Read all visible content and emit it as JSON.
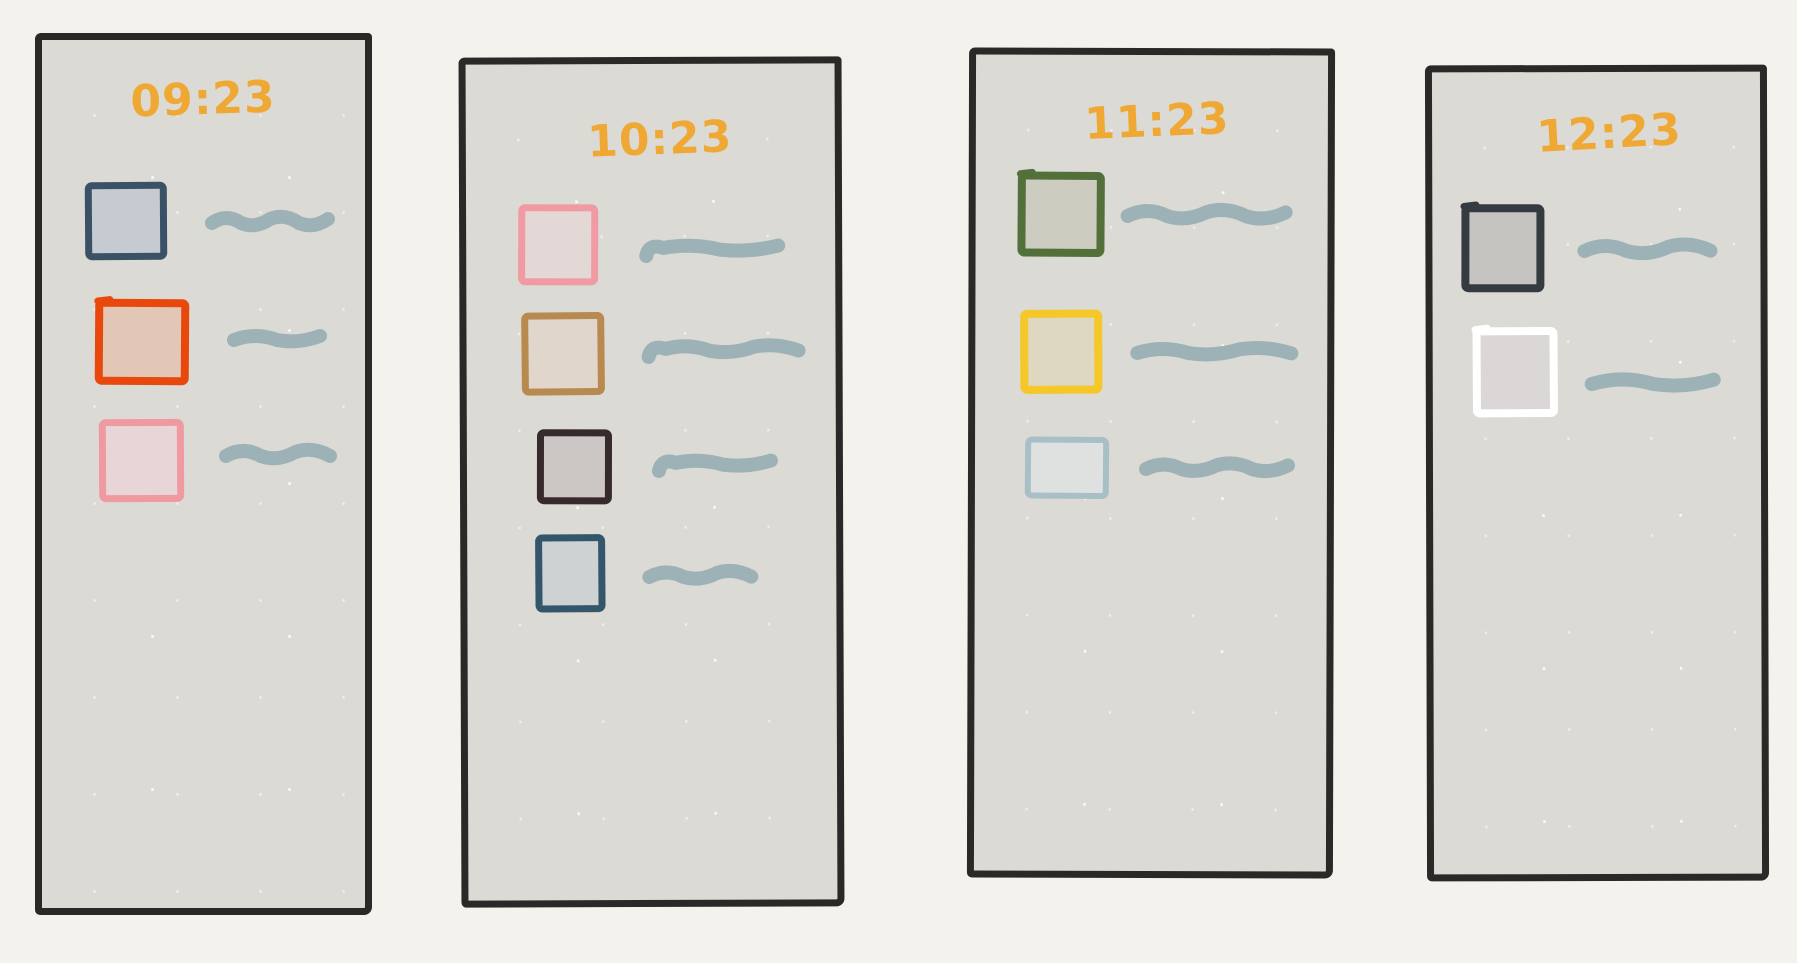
{
  "colors": {
    "background": "#f4f2ed",
    "panel_background": "#dbdad5",
    "panel_border": "#2b2927",
    "time_text": "#f0a834",
    "squiggle_stroke": "#9db2b7"
  },
  "panels": [
    {
      "time": "09:23",
      "frame": {
        "x": 35,
        "y": 33,
        "w": 337,
        "h": 882,
        "rotate": 0
      },
      "time_pos": {
        "x": 76,
        "y": 38,
        "rotate": -2
      },
      "items": [
        {
          "checkbox": {
            "x": 43,
            "y": 142,
            "w": 82,
            "h": 78,
            "border": "#3a5166",
            "fill": "#c6cbd1",
            "bw": 7,
            "overshoot": false,
            "rotate": -0.4,
            "state": "unchecked"
          },
          "squiggle": {
            "x": 163,
            "y": 165,
            "len": 130,
            "bumps": 4,
            "amp": 8,
            "style": "wave"
          }
        },
        {
          "checkbox": {
            "x": 53,
            "y": 259,
            "w": 94,
            "h": 86,
            "border": "#e8480c",
            "fill": "#e2c7b6",
            "bw": 8,
            "overshoot": true,
            "rotate": 0.4,
            "state": "unchecked"
          },
          "squiggle": {
            "x": 185,
            "y": 282,
            "len": 100,
            "bumps": 2,
            "amp": 6,
            "style": "wave"
          }
        },
        {
          "checkbox": {
            "x": 57,
            "y": 379,
            "w": 85,
            "h": 83,
            "border": "#ef9aa0",
            "fill": "#e7d5d8",
            "bw": 7,
            "overshoot": false,
            "rotate": -0.3,
            "state": "unchecked"
          },
          "squiggle": {
            "x": 177,
            "y": 398,
            "len": 118,
            "bumps": 3,
            "amp": 8,
            "style": "wave"
          }
        }
      ]
    },
    {
      "time": "10:23",
      "frame": {
        "x": 460,
        "y": 57,
        "w": 383,
        "h": 850,
        "rotate": -0.2
      },
      "time_pos": {
        "x": 109,
        "y": 54,
        "rotate": -2
      },
      "items": [
        {
          "checkbox": {
            "x": 52,
            "y": 140,
            "w": 80,
            "h": 81,
            "border": "#f09ba4",
            "fill": "#e4d8d6",
            "bw": 7,
            "overshoot": false,
            "rotate": 0.3,
            "state": "unchecked"
          },
          "squiggle": {
            "x": 173,
            "y": 168,
            "len": 146,
            "bumps": 2,
            "amp": 5,
            "style": "hook"
          }
        },
        {
          "checkbox": {
            "x": 55,
            "y": 248,
            "w": 83,
            "h": 83,
            "border": "#b98a50",
            "fill": "#e0d6cc",
            "bw": 7,
            "overshoot": false,
            "rotate": -0.4,
            "state": "unchecked"
          },
          "squiggle": {
            "x": 175,
            "y": 269,
            "len": 164,
            "bumps": 3,
            "amp": 6,
            "style": "hook"
          }
        },
        {
          "checkbox": {
            "x": 70,
            "y": 365,
            "w": 75,
            "h": 75,
            "border": "#372a2c",
            "fill": "#ccc6c4",
            "bw": 7,
            "overshoot": false,
            "rotate": 0.3,
            "state": "unchecked"
          },
          "squiggle": {
            "x": 185,
            "y": 383,
            "len": 126,
            "bumps": 2,
            "amp": 5,
            "style": "hook"
          }
        },
        {
          "checkbox": {
            "x": 68,
            "y": 470,
            "w": 70,
            "h": 78,
            "border": "#33566b",
            "fill": "#ced2d3",
            "bw": 7,
            "overshoot": false,
            "rotate": -0.2,
            "state": "unchecked"
          },
          "squiggle": {
            "x": 175,
            "y": 495,
            "len": 116,
            "bumps": 3,
            "amp": 7,
            "style": "wave"
          }
        }
      ]
    },
    {
      "time": "11:23",
      "frame": {
        "x": 968,
        "y": 48,
        "w": 366,
        "h": 830,
        "rotate": 0.15
      },
      "time_pos": {
        "x": 96,
        "y": 45,
        "rotate": -2.5
      },
      "items": [
        {
          "checkbox": {
            "x": 42,
            "y": 117,
            "w": 87,
            "h": 85,
            "border": "#53703b",
            "fill": "#ccccc0",
            "bw": 8,
            "overshoot": true,
            "rotate": 0.2,
            "state": "unchecked"
          },
          "squiggle": {
            "x": 145,
            "y": 143,
            "len": 172,
            "bumps": 4,
            "amp": 8,
            "style": "wave"
          }
        },
        {
          "checkbox": {
            "x": 45,
            "y": 255,
            "w": 82,
            "h": 84,
            "border": "#f5c728",
            "fill": "#ded8c0",
            "bw": 8,
            "overshoot": false,
            "rotate": -0.3,
            "state": "unchecked"
          },
          "squiggle": {
            "x": 155,
            "y": 280,
            "len": 168,
            "bumps": 3,
            "amp": 6,
            "style": "wave"
          }
        },
        {
          "checkbox": {
            "x": 50,
            "y": 382,
            "w": 84,
            "h": 62,
            "border": "#a9bfc7",
            "fill": "#dee1df",
            "bw": 6,
            "overshoot": false,
            "rotate": 0.3,
            "state": "unchecked"
          },
          "squiggle": {
            "x": 164,
            "y": 396,
            "len": 156,
            "bumps": 4,
            "amp": 7,
            "style": "wave"
          }
        }
      ]
    },
    {
      "time": "12:23",
      "frame": {
        "x": 1426,
        "y": 65,
        "w": 342,
        "h": 816,
        "rotate": -0.15
      },
      "time_pos": {
        "x": 92,
        "y": 40,
        "rotate": -3
      },
      "items": [
        {
          "checkbox": {
            "x": 29,
            "y": 132,
            "w": 83,
            "h": 88,
            "border": "#343c42",
            "fill": "#c6c4c0",
            "bw": 8,
            "overshoot": true,
            "rotate": 0.2,
            "state": "unchecked"
          },
          "squiggle": {
            "x": 145,
            "y": 161,
            "len": 140,
            "bumps": 3,
            "amp": 8,
            "style": "wave"
          }
        },
        {
          "checkbox": {
            "x": 40,
            "y": 255,
            "w": 85,
            "h": 90,
            "border": "#ffffff",
            "fill": "#dbd7d6",
            "bw": 8,
            "overshoot": true,
            "rotate": -0.2,
            "state": "unchecked"
          },
          "squiggle": {
            "x": 152,
            "y": 294,
            "len": 136,
            "bumps": 2,
            "amp": 7,
            "style": "wave"
          }
        }
      ]
    }
  ]
}
